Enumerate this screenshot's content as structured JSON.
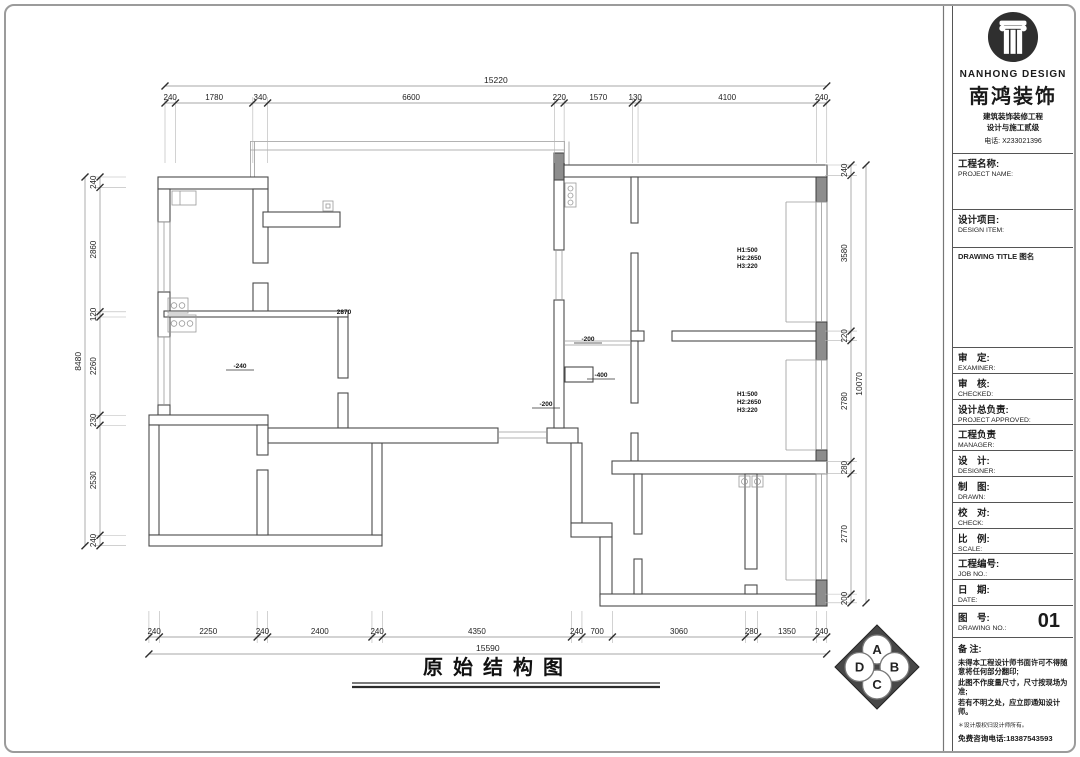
{
  "logo": {
    "brand_en": "NANHONG DESIGN",
    "brand_cn": "南鸿装饰",
    "subtitle1": "建筑装饰装修工程",
    "subtitle2": "设计与施工贰级",
    "phone": "电话: X233021396"
  },
  "titleblock": {
    "project_cn": "工程名称:",
    "project_en": "PROJECT NAME:",
    "design_cn": "设计项目:",
    "design_en": "DESIGN ITEM:",
    "drawing_title_label": "DRAWING TITLE 图名",
    "rows": [
      {
        "cn": "审　定:",
        "en": "EXAMINER:"
      },
      {
        "cn": "审　核:",
        "en": "CHECKED:"
      },
      {
        "cn": "设计总负责:",
        "en": "PROJECT APPROVED:"
      },
      {
        "cn": "工程负责",
        "en": "MANAGER:"
      },
      {
        "cn": "设　计:",
        "en": "DESIGNER:"
      },
      {
        "cn": "制　图:",
        "en": "DRAWN:"
      },
      {
        "cn": "校　对:",
        "en": "CHECK:"
      },
      {
        "cn": "比　例:",
        "en": "SCALE:"
      },
      {
        "cn": "工程编号:",
        "en": "JOB  NO.:"
      },
      {
        "cn": "日　期:",
        "en": "DATE:"
      }
    ],
    "drawno_cn": "图　号:",
    "drawno_en": "DRAWING NO.:",
    "drawing_no": "01",
    "notes_title": "备 注:",
    "notes": [
      "未得本工程设计师书面许可不得随意将任何部分翻印;",
      "此图不作度量尺寸，尺寸按现场为准;",
      "若有不明之处，应立即通知设计师。"
    ],
    "copyright_note": "＊设计版权归设计师所有。",
    "hotline": "免费咨询电话:18387543593"
  },
  "plan": {
    "title": "原始结构图",
    "levels": {
      "center": "2870",
      "left": "-240",
      "hall_top": "-200",
      "hall_mid": "-400",
      "hall_left": "-200"
    },
    "window_spec": [
      "H1:500",
      "H2:2650",
      "H3:220"
    ],
    "compass": [
      "A",
      "B",
      "C",
      "D"
    ]
  },
  "dimensions": {
    "top": {
      "total": "15220",
      "segments": [
        240,
        1780,
        340,
        6600,
        220,
        1570,
        130,
        4100,
        240
      ]
    },
    "bottom": {
      "total": "15590",
      "segments": [
        240,
        2250,
        240,
        2400,
        240,
        4350,
        240,
        700,
        3060,
        280,
        1350,
        240
      ]
    },
    "left": {
      "total": "8480",
      "segments": [
        240,
        2860,
        120,
        2260,
        230,
        2530,
        240
      ]
    },
    "right": {
      "total": "10070",
      "segments": [
        240,
        3580,
        220,
        2780,
        280,
        2770,
        200
      ]
    }
  }
}
